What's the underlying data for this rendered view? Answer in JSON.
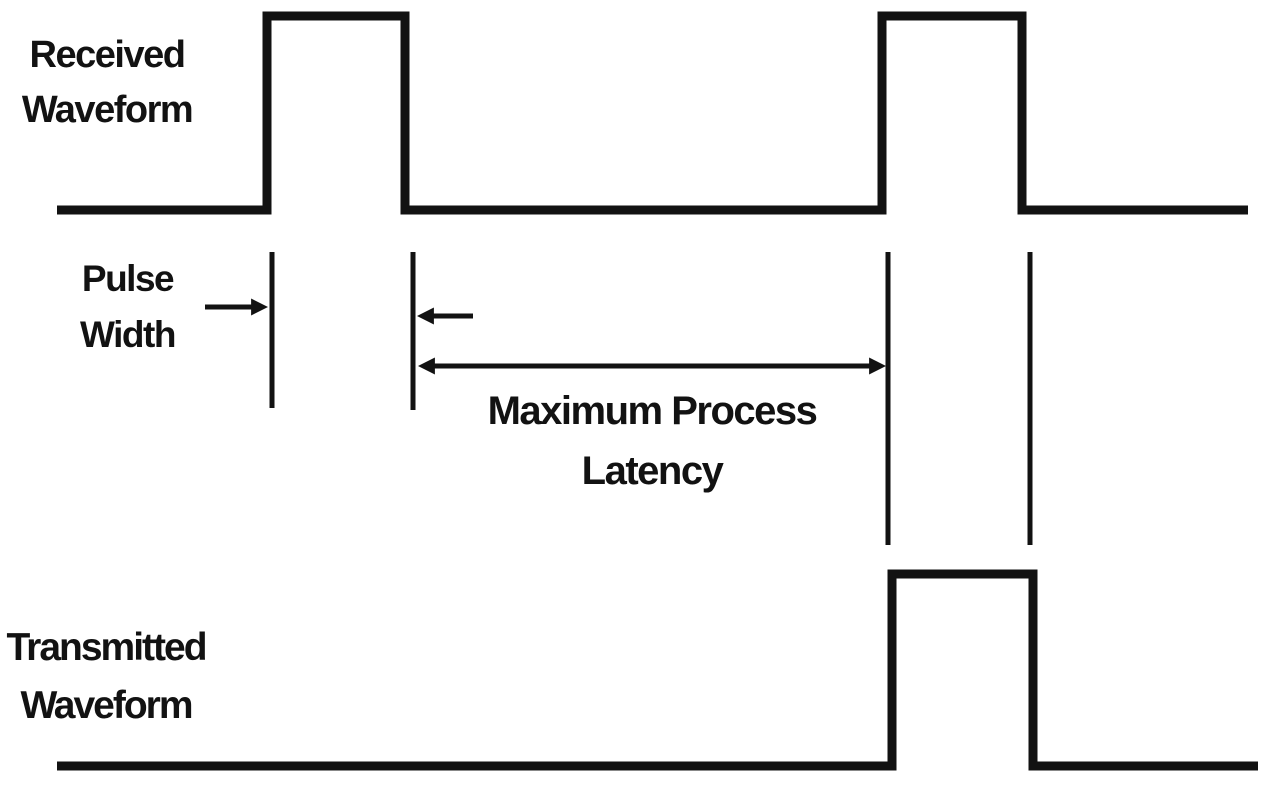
{
  "theme": {
    "background_color": "#ffffff",
    "ink_color": "#121212"
  },
  "diagram": {
    "received_label": "Received Waveform",
    "pulse_width_label": "Pulse Width",
    "latency_label": "Maximum Process Latency",
    "transmitted_label": "Transmitted Waveform"
  }
}
